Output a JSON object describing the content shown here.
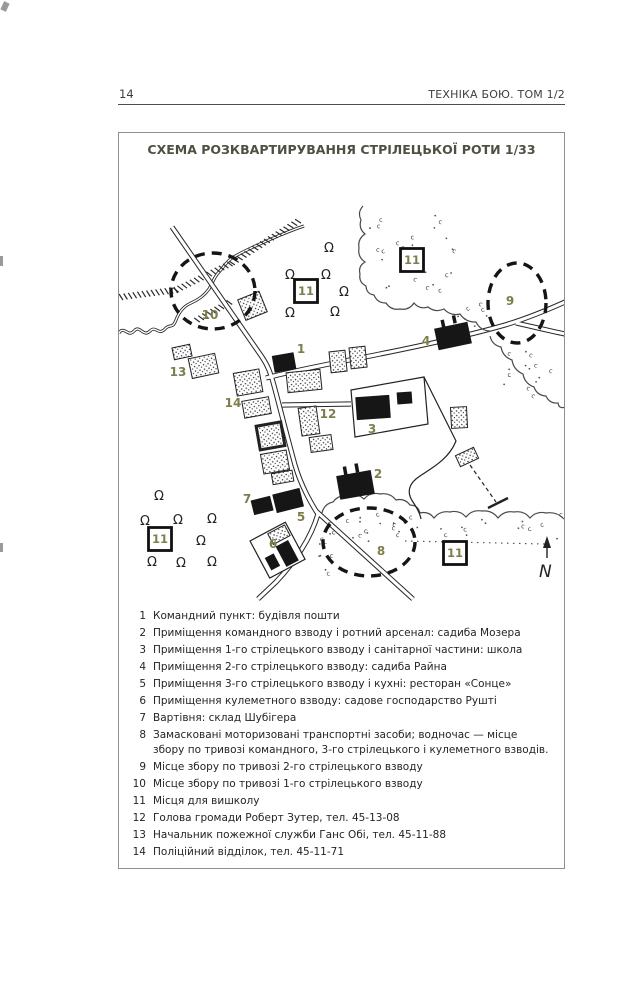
{
  "page": {
    "number": "14",
    "running_title": "ТЕХНІКА БОЮ. ТОМ 1/2"
  },
  "figure": {
    "title": "СХЕМА РОЗКВАРТИРУВАННЯ СТРІЛЕЦЬКОЇ РОТИ 1/33"
  },
  "colors": {
    "label_olive": "#7e7e4c",
    "title": "#4d5142",
    "ink": "#1d1d1d"
  },
  "map": {
    "markers": [
      {
        "n": "1",
        "x": 301,
        "y": 349
      },
      {
        "n": "2",
        "x": 378,
        "y": 474
      },
      {
        "n": "3",
        "x": 372,
        "y": 429
      },
      {
        "n": "4",
        "x": 426,
        "y": 341
      },
      {
        "n": "5",
        "x": 301,
        "y": 517
      },
      {
        "n": "6",
        "x": 273,
        "y": 544
      },
      {
        "n": "7",
        "x": 247,
        "y": 499
      },
      {
        "n": "8",
        "x": 381,
        "y": 551
      },
      {
        "n": "9",
        "x": 510,
        "y": 301
      },
      {
        "n": "10",
        "x": 210,
        "y": 315
      },
      {
        "n": "12",
        "x": 328,
        "y": 414
      },
      {
        "n": "13",
        "x": 178,
        "y": 372
      },
      {
        "n": "14",
        "x": 233,
        "y": 403
      }
    ],
    "training_boxes": [
      {
        "label": "11",
        "x": 306,
        "y": 291
      },
      {
        "label": "11",
        "x": 412,
        "y": 260
      },
      {
        "label": "11",
        "x": 160,
        "y": 539
      },
      {
        "label": "11",
        "x": 455,
        "y": 553
      }
    ],
    "alarm_ellipses": [
      {
        "label": "10",
        "cx": 213,
        "cy": 291,
        "rx": 42,
        "ry": 38
      },
      {
        "label": "9",
        "cx": 517,
        "cy": 303,
        "rx": 29,
        "ry": 40
      },
      {
        "label": "8",
        "cx": 369,
        "cy": 542,
        "rx": 46,
        "ry": 34
      }
    ],
    "north": "N"
  },
  "legend": {
    "items": [
      {
        "num": "1",
        "text": "Командний пункт: будівля пошти"
      },
      {
        "num": "2",
        "text": "Приміщення командного взводу і ротний арсенал: садиба Мозера"
      },
      {
        "num": "3",
        "text": "Приміщення 1-го стрілецького взводу і санітарної частини: школа"
      },
      {
        "num": "4",
        "text": "Приміщення 2-го стрілецького взводу: садиба Райна"
      },
      {
        "num": "5",
        "text": "Приміщення 3-го стрілецького взводу і кухні: ресторан «Сонце»"
      },
      {
        "num": "6",
        "text": "Приміщення кулеметного взводу: садове господарство Рушті"
      },
      {
        "num": "7",
        "text": "Вартівня: склад Шубігера"
      },
      {
        "num": "8",
        "text": "Замасковані моторизовані транспортні засоби; водночас — місце збору по тривозі командного, 3-го стрілецького і кулеметного взводів."
      },
      {
        "num": "9",
        "text": "Місце збору по тривозі 2-го стрілецького взводу"
      },
      {
        "num": "10",
        "text": "Місце збору по тривозі 1-го стрілецького взводу"
      },
      {
        "num": "11",
        "text": "Місця для вишколу"
      },
      {
        "num": "12",
        "text": "Голова громади Роберт Зутер, тел. 45-13-08"
      },
      {
        "num": "13",
        "text": "Начальник пожежної служби Ганс Обі, тел. 45-11-88"
      },
      {
        "num": "14",
        "text": "Поліційний відділок, тел. 45-11-71"
      }
    ]
  }
}
